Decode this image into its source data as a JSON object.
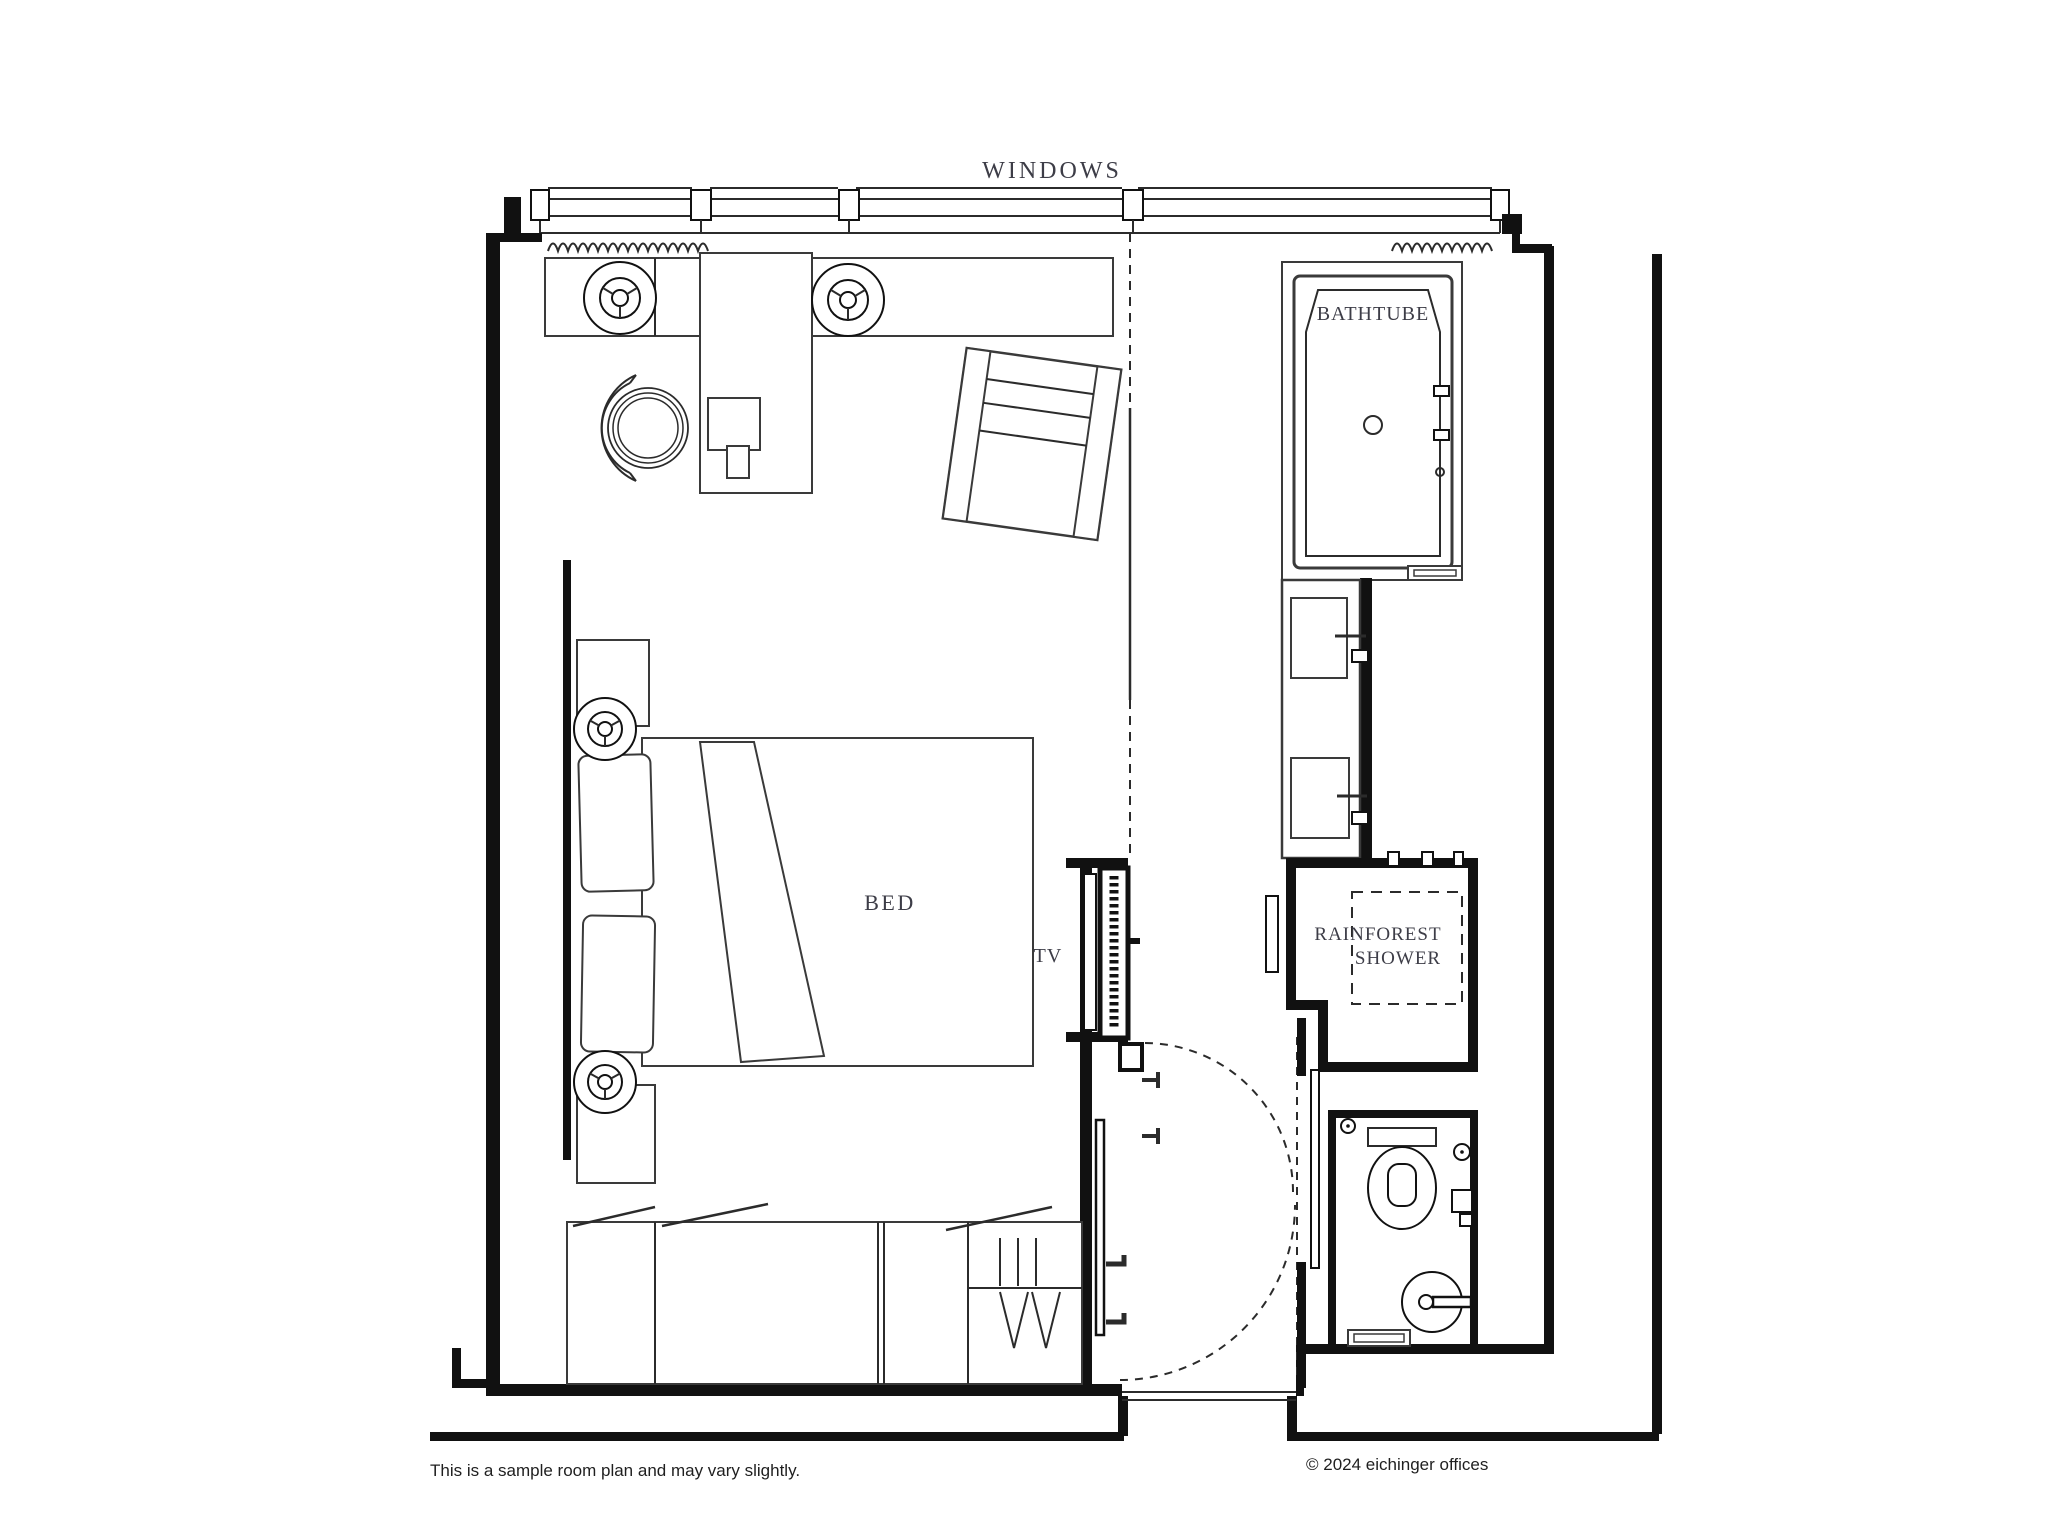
{
  "title": "Sample hotel room floor plan",
  "labels": {
    "windows": "WINDOWS",
    "bathtube": "BATHTUBE",
    "bed": "BED",
    "tv": "TV",
    "rainforest_line1": "RAINFOREST",
    "rainforest_line2": "SHOWER"
  },
  "footer": {
    "disclaimer": "This is a sample room plan and may vary slightly.",
    "copyright": "© 2024 eichinger offices"
  },
  "colors": {
    "background": "#ffffff",
    "wall": "#111111",
    "thin_line": "#2b2b2b",
    "label_text": "#3d3d47",
    "footer_text": "#1f1f1f"
  }
}
